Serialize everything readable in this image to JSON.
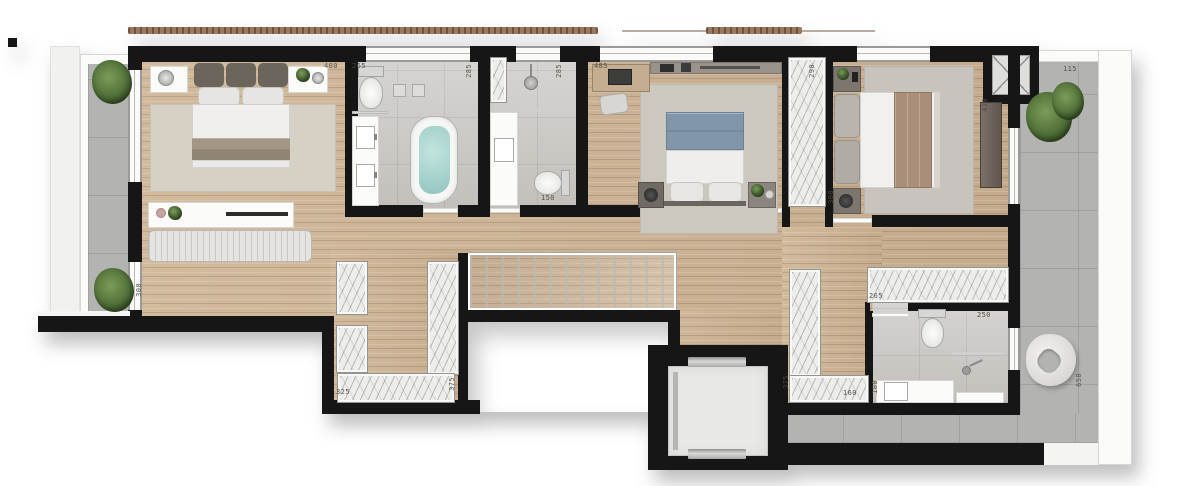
{
  "plan": {
    "type": "floor-plan-upper-level",
    "colors": {
      "wall": "#161616",
      "wood": "#cdb292",
      "tile_bath": "#cac7c3",
      "tile_terrace": "#b3b3b1",
      "marble": "#efefec",
      "water": "#a5d2cc",
      "accent_blue": "#8196ab",
      "accent_tan": "#a98f79",
      "blanket_taupe": "#a39685",
      "cushion_dark": "#6b655c",
      "plant": "#33491f",
      "brise": "#9a7a5e",
      "label": "#4d483f"
    },
    "dimension_labels": [
      {
        "name": "bedroom1-width",
        "text": "400",
        "x": 324,
        "y": 63,
        "vertical": false
      },
      {
        "name": "bath1-width",
        "text": "265",
        "x": 352,
        "y": 63,
        "vertical": false
      },
      {
        "name": "bath1-depth",
        "text": "285",
        "x": 466,
        "y": 64,
        "vertical": true
      },
      {
        "name": "bath2-depth",
        "text": "285",
        "x": 556,
        "y": 64,
        "vertical": true
      },
      {
        "name": "bedroom2-width",
        "text": "485",
        "x": 594,
        "y": 63,
        "vertical": false
      },
      {
        "name": "wardrobe2-length",
        "text": "290",
        "x": 809,
        "y": 64,
        "vertical": true
      },
      {
        "name": "bedroom3-depth",
        "text": "410",
        "x": 982,
        "y": 98,
        "vertical": true
      },
      {
        "name": "terrace-width",
        "text": "115",
        "x": 1063,
        "y": 66,
        "vertical": false
      },
      {
        "name": "balcony-depth",
        "text": "300",
        "x": 136,
        "y": 283,
        "vertical": true
      },
      {
        "name": "bath2-width",
        "text": "150",
        "x": 541,
        "y": 195,
        "vertical": false
      },
      {
        "name": "bedroom3-entry",
        "text": "300",
        "x": 828,
        "y": 190,
        "vertical": true
      },
      {
        "name": "wardrobe3-length",
        "text": "265",
        "x": 869,
        "y": 293,
        "vertical": false
      },
      {
        "name": "bath3-width",
        "text": "250",
        "x": 977,
        "y": 312,
        "vertical": false
      },
      {
        "name": "bath3-vanity",
        "text": "180",
        "x": 872,
        "y": 380,
        "vertical": true
      },
      {
        "name": "closet2-width",
        "text": "160",
        "x": 843,
        "y": 390,
        "vertical": false
      },
      {
        "name": "closet2-depth",
        "text": "375",
        "x": 783,
        "y": 375,
        "vertical": true
      },
      {
        "name": "closet1-width",
        "text": "325",
        "x": 336,
        "y": 389,
        "vertical": false
      },
      {
        "name": "closet1-depth",
        "text": "375",
        "x": 449,
        "y": 377,
        "vertical": true
      },
      {
        "name": "terrace-length",
        "text": "650",
        "x": 1076,
        "y": 373,
        "vertical": true
      }
    ],
    "rooms": [
      "master-bedroom",
      "master-bathroom",
      "shower-bathroom",
      "bedroom-2",
      "bedroom-3",
      "hallway",
      "walk-in-closet",
      "corridor-closet",
      "bathroom-3",
      "left-balcony",
      "right-terrace",
      "staircase",
      "elevator",
      "void-open-below"
    ],
    "furniture_icons": [
      "double-bed-icon",
      "nightstand-icon",
      "table-lamp-icon",
      "area-rug-icon",
      "bench-icon",
      "console-table-icon",
      "toilet-icon",
      "double-vanity-icon",
      "bathtub-icon",
      "shower-head-icon",
      "vanity-sink-icon",
      "desk-icon",
      "desk-chair-icon",
      "wall-shelf-icon",
      "wardrobe-icon",
      "dresser-icon",
      "staircase-icon",
      "elevator-cab-icon",
      "lounge-chair-icon",
      "potted-plant-icon",
      "duct-shaft-icon",
      "pergola-icon"
    ]
  }
}
